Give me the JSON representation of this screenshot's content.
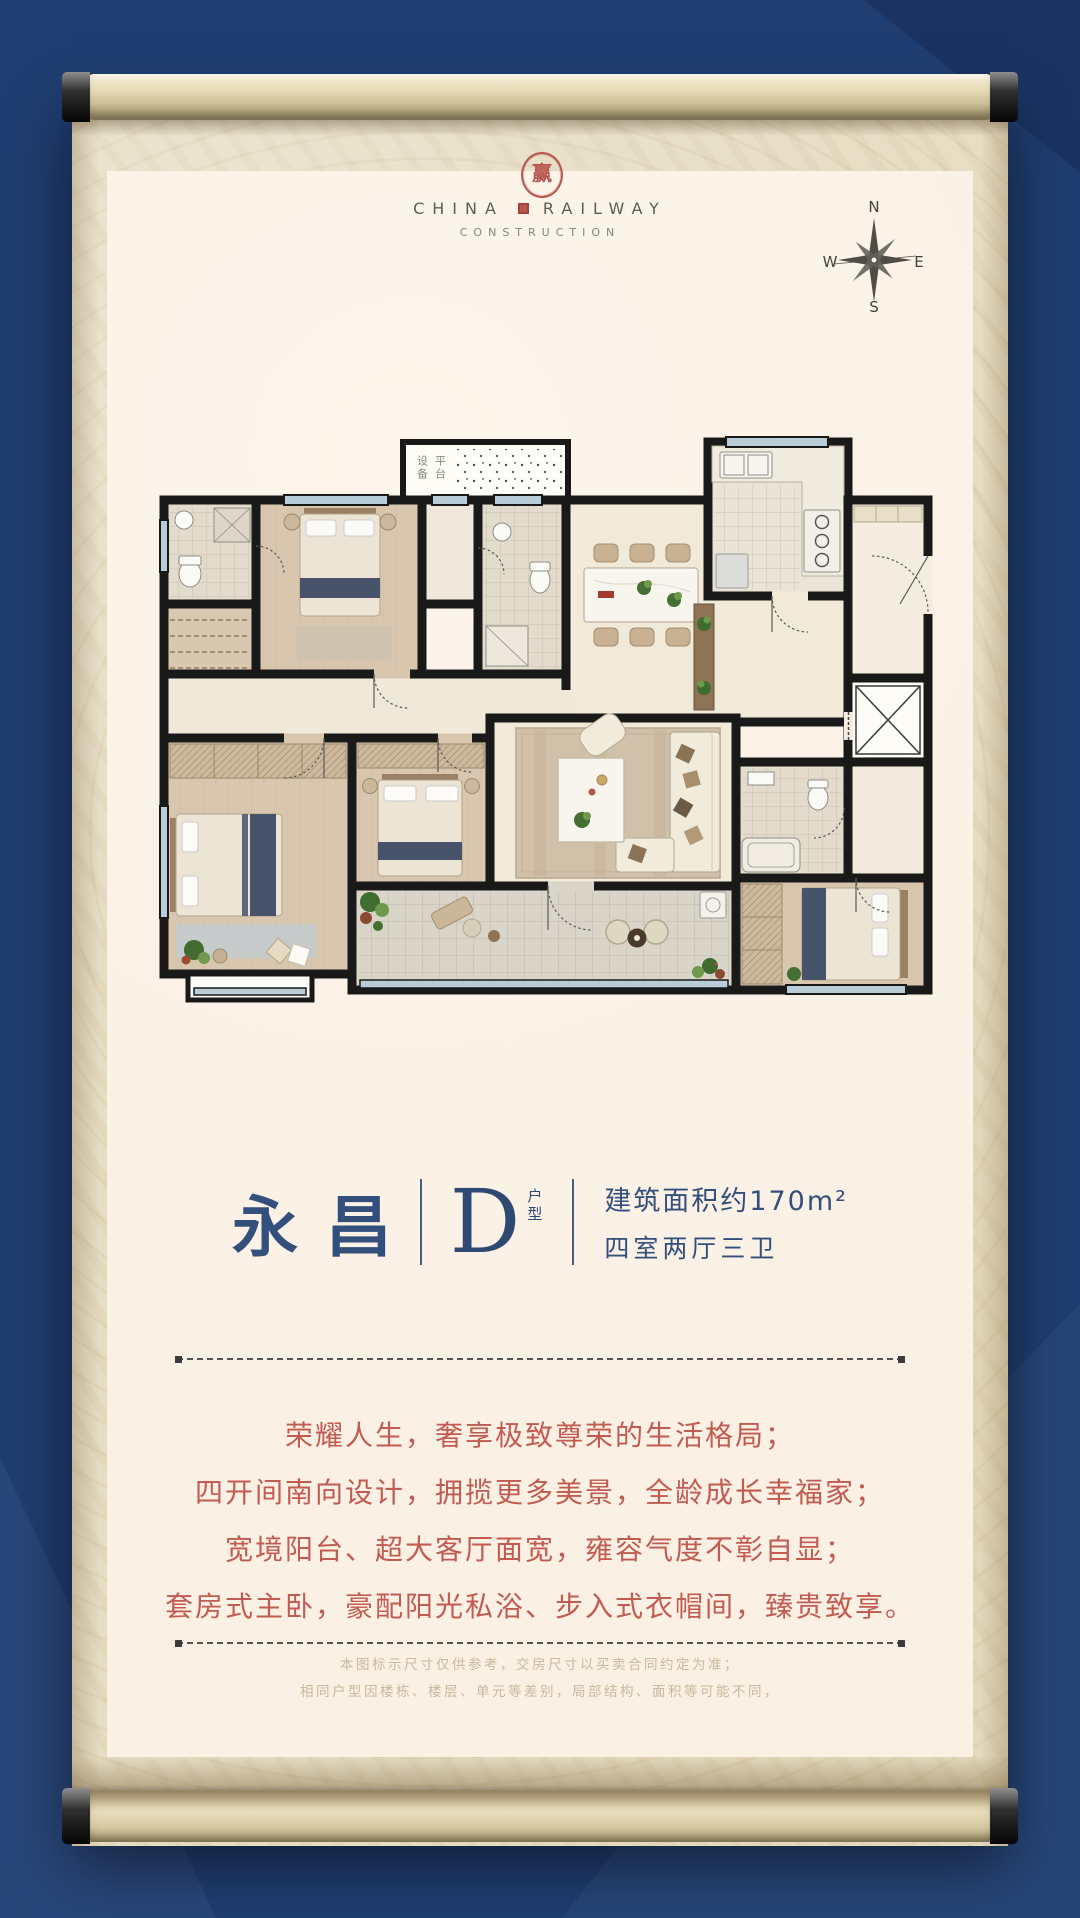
{
  "logo": {
    "seal_character": "赢",
    "line1_left": "CHINA",
    "line1_right": "RAILWAY",
    "line2": "CONSTRUCTION"
  },
  "compass": {
    "n": "N",
    "e": "E",
    "s": "S",
    "w": "W"
  },
  "floor_plan": {
    "platform_label_col1": "设备",
    "platform_label_col2": "平台"
  },
  "title": {
    "name": "永昌",
    "unit_letter": "D",
    "unit_suffix": "户型",
    "area": "建筑面积约170m²",
    "layout": "四室两厅三卫"
  },
  "description": {
    "lines": [
      "荣耀人生，奢享极致尊荣的生活格局；",
      "四开间南向设计，拥揽更多美景，全龄成长幸福家；",
      "宽境阳台、超大客厅面宽，雍容气度不彰自显；",
      "套房式主卧，豪配阳光私浴、步入式衣帽间，臻贵致享。"
    ]
  },
  "disclaimer": {
    "lines": [
      "本图标示尺寸仅供参考，交房尺寸以买卖合同约定为准；",
      "相同户型因楼栋、楼层、单元等差别，局部结构、面积等可能不同，"
    ]
  },
  "colors": {
    "background_navy": "#1f3d70",
    "paper_beige": "#e7ddc3",
    "panel_cream": "#faf0e4",
    "accent_navy": "#33507c",
    "accent_red": "#c25b51",
    "seal_red": "#b6564f",
    "disclaimer_text": "#c9b89d",
    "wall_black": "#191919"
  }
}
